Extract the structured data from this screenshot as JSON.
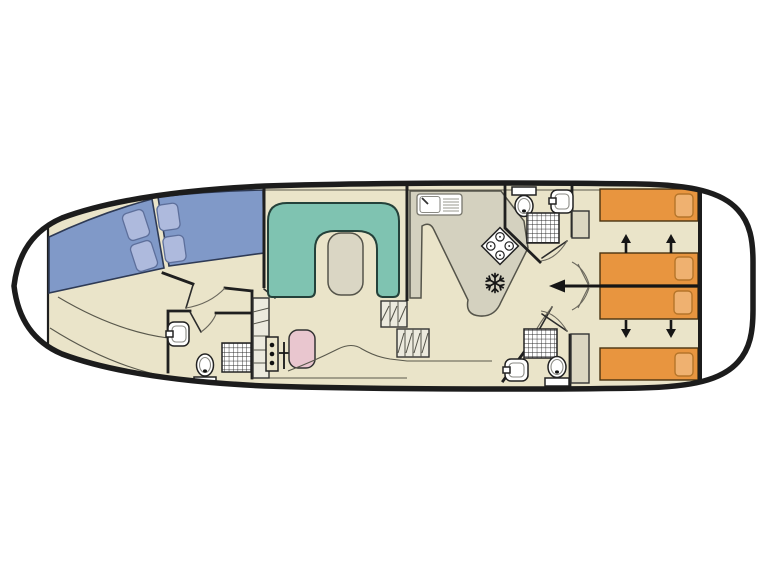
{
  "diagram": {
    "type": "boat-floor-plan",
    "view": "top-down deck plan of a canal cruiser houseboat",
    "orientation": {
      "bow": "left",
      "stern": "right"
    }
  },
  "colors": {
    "background": "#ffffff",
    "hull_outline": "#1c1c1c",
    "floor": "#eae4c9",
    "bow_bed": "#8099c8",
    "bow_pillow": "#aebadd",
    "sofa": "#7fc3b1",
    "table": "#dad6c4",
    "counter": "#d4d1bf",
    "helm_seat": "#e9c6cf",
    "aft_bed": "#e8953f",
    "aft_pillow": "#efb170",
    "wardrobe": "#dbd6c1",
    "fixture": "#ffffff",
    "steps": "#eceade"
  },
  "rooms": [
    {
      "id": "bow-locker",
      "name": "bow locker (pointed bow)",
      "fixtures": []
    },
    {
      "id": "bow-cabin",
      "name": "bow v-berth cabin",
      "fixtures": [
        "v-double-bed",
        "pillow x4"
      ]
    },
    {
      "id": "bow-bathroom",
      "name": "forward bathroom",
      "fixtures": [
        "sink-icon",
        "toilet-icon",
        "shower-icon"
      ]
    },
    {
      "id": "saloon",
      "name": "saloon with dinette and helm",
      "fixtures": [
        "u-shaped-sofa",
        "table",
        "helm-seat",
        "helm-controls",
        "steps x2"
      ]
    },
    {
      "id": "galley",
      "name": "galley",
      "fixtures": [
        "sink-drainer-icon",
        "stove-4-burner-icon",
        "fridge-snowflake-icon",
        "l-shaped-counter"
      ]
    },
    {
      "id": "aft-bathroom-top",
      "name": "aft bathroom port",
      "fixtures": [
        "toilet-icon",
        "sink-icon",
        "shower-icon"
      ]
    },
    {
      "id": "aft-bathroom-bottom",
      "name": "aft bathroom starboard",
      "fixtures": [
        "shower-icon",
        "sink-icon",
        "toilet-icon"
      ]
    },
    {
      "id": "aft-cabin-top",
      "name": "aft cabin port",
      "fixtures": [
        "single-bed x2",
        "wardrobe",
        "slide-arrows"
      ]
    },
    {
      "id": "aft-cabin-bottom",
      "name": "aft cabin starboard",
      "fixtures": [
        "single-bed x2",
        "wardrobe",
        "slide-arrows"
      ]
    },
    {
      "id": "stern-deck",
      "name": "stern deck",
      "fixtures": []
    }
  ],
  "counts": {
    "bow_berths": 2,
    "aft_single_beds": 4,
    "bathrooms": 3,
    "showers": 3,
    "toilets": 3,
    "sinks_bathroom": 3,
    "sofa_tables": 1
  },
  "annotations": {
    "sliding_bed_arrows": [
      "up",
      "up",
      "down",
      "down"
    ],
    "partition_arrow_direction": "left"
  }
}
